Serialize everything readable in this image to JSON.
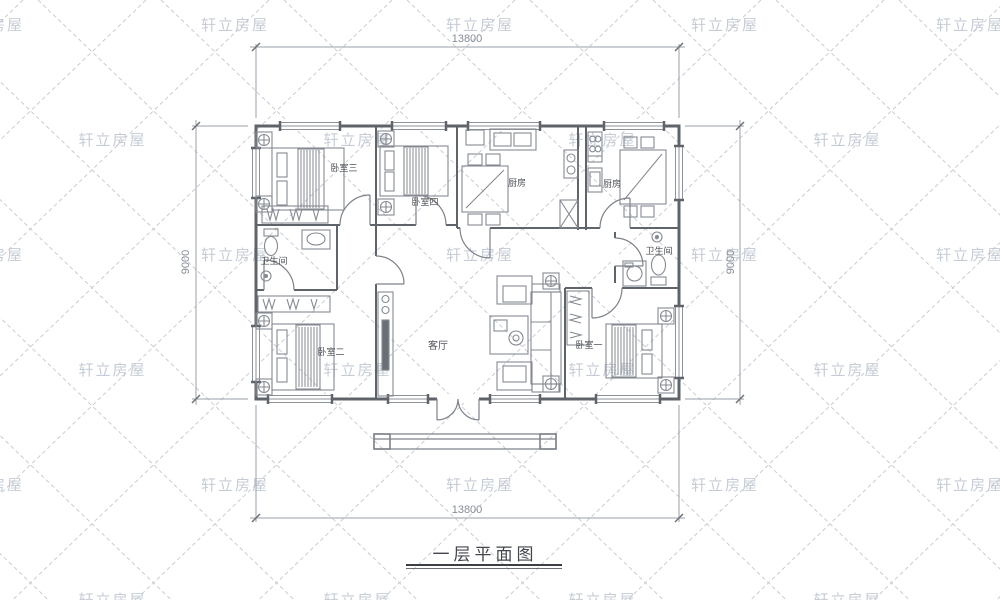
{
  "watermark": {
    "text": "轩立房屋"
  },
  "title": {
    "text": "一层平面图"
  },
  "dims": {
    "top": "13800",
    "bottom": "13800",
    "left": "9000",
    "right": "9000"
  },
  "rooms": {
    "bedroom3": {
      "label": "卧室三"
    },
    "bedroom4": {
      "label": "卧室四"
    },
    "kitchen_left": {
      "label": "厨房"
    },
    "kitchen_right": {
      "label": "厨房"
    },
    "bath_left": {
      "label": "卫生间"
    },
    "bath_right": {
      "label": "卫生间"
    },
    "living": {
      "label": "客厅"
    },
    "bedroom2": {
      "label": "卧室二"
    },
    "bedroom1": {
      "label": "卧室一"
    }
  },
  "colors": {
    "wall": "#5f646b",
    "furniture": "#858a92",
    "dimension_line": "#9aa0a8",
    "dimension_text": "#868c97",
    "room_label": "#4e5258",
    "watermark": "#b9c0cc",
    "lattice": "#caccd2",
    "title": "#43474d"
  }
}
